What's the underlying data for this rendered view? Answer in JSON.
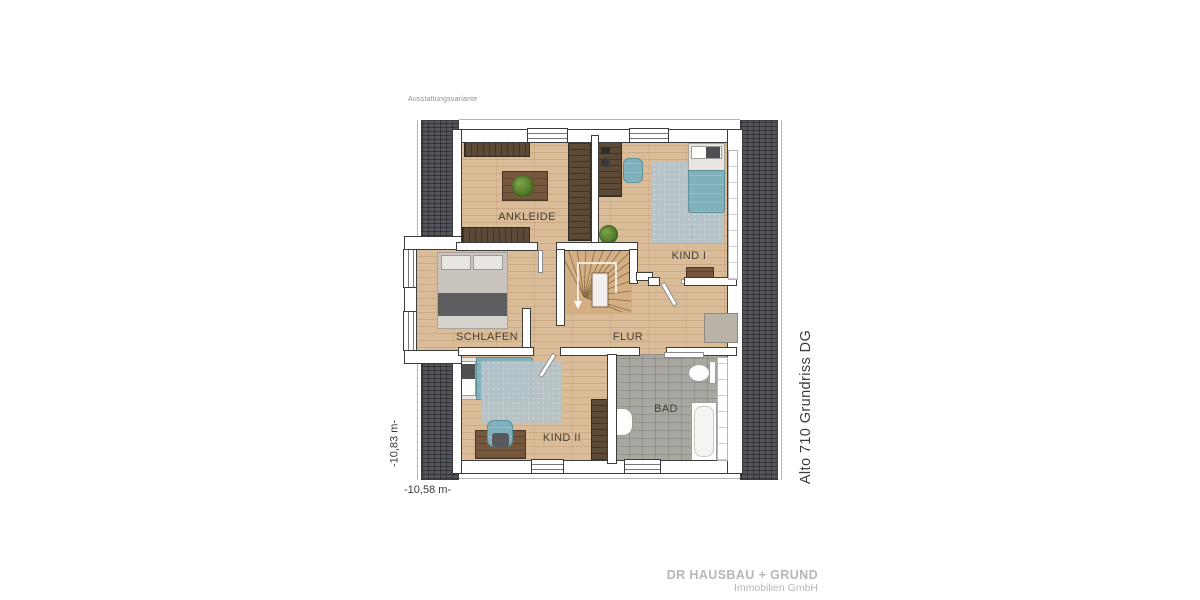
{
  "header": {
    "variant_label": "Ausstattungsvariante"
  },
  "title": {
    "plan_label": "Alto 710 Grundriss DG"
  },
  "dimensions": {
    "vertical": "-10,83 m-",
    "horizontal": "-10,58 m-"
  },
  "rooms": [
    {
      "label": "ANKLEIDE"
    },
    {
      "label": "KIND I"
    },
    {
      "label": "SCHLAFEN"
    },
    {
      "label": "FLUR"
    },
    {
      "label": "KIND II"
    },
    {
      "label": "BAD"
    }
  ],
  "branding": {
    "company": "DR HAUSBAU + GRUND",
    "subline": "Immobilien GmbH"
  },
  "colors": {
    "roof": "#53545a",
    "floor": "#dabd98",
    "tile": "#a8a7a0",
    "accent_teal": "#7fb0bc",
    "rug": "#b5c3c9",
    "wood_dark": "#5c4936",
    "wood_mid": "#75573d",
    "wall_line": "#3c3c3c"
  }
}
